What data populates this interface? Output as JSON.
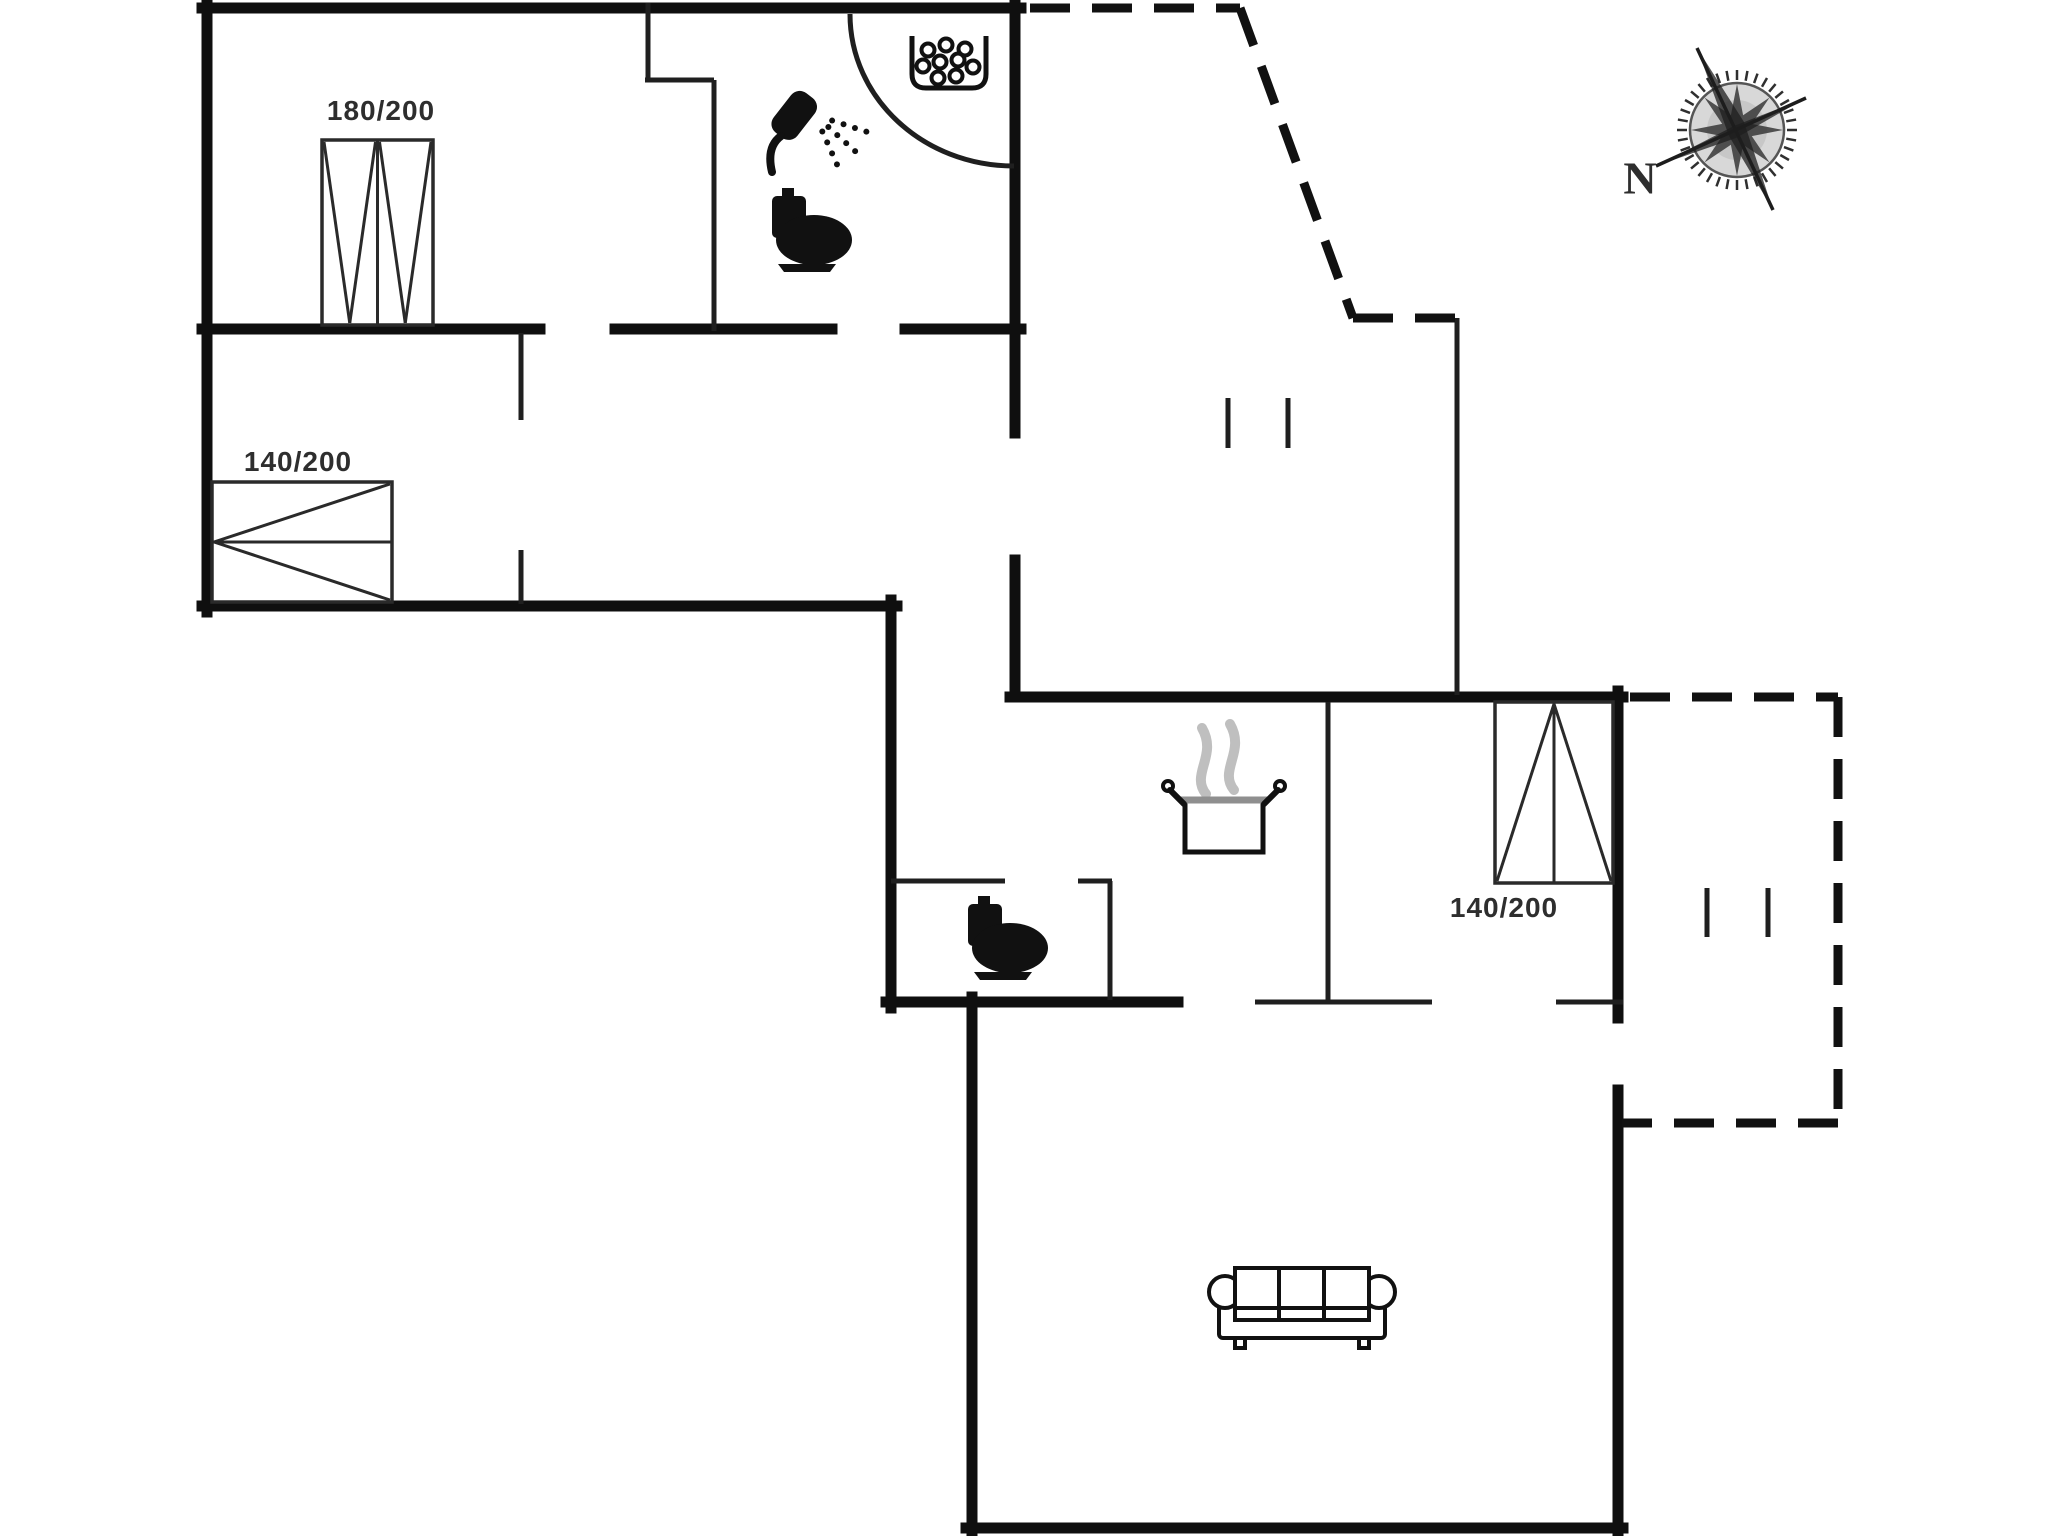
{
  "page": {
    "width": 2048,
    "height": 1536,
    "background": "#ffffff"
  },
  "colors": {
    "wall": "#0f0f0f",
    "thin_line": "#1f1f1f",
    "bed_line": "#2a2a2a",
    "dashed_boundary": "#111111",
    "icon": "#111111",
    "steam": "#bfbfbf",
    "pot_rim": "#8f8f8f",
    "compass_fill": "#d8d8d8",
    "compass_star": "#3c3c3c",
    "label_text": "#2e2e2e"
  },
  "plan": {
    "wall_thickness": 11,
    "thin_thickness": 5,
    "dash_pattern": [
      40,
      22
    ],
    "walls_thick": [
      [
        202,
        8,
        1021,
        8
      ],
      [
        207,
        3,
        207,
        612
      ],
      [
        202,
        606,
        897,
        606
      ],
      [
        891,
        600,
        891,
        1008
      ],
      [
        1015,
        3,
        1015,
        433
      ],
      [
        1015,
        560,
        1015,
        697
      ],
      [
        1010,
        697,
        1623,
        697
      ],
      [
        1618,
        691,
        1618,
        1018
      ],
      [
        1618,
        1090,
        1618,
        1533
      ],
      [
        886,
        1002,
        1178,
        1002
      ],
      [
        972,
        997,
        972,
        1533
      ],
      [
        966,
        1528,
        1623,
        1528
      ],
      [
        202,
        329,
        540,
        329
      ],
      [
        615,
        329,
        832,
        329
      ],
      [
        905,
        329,
        1021,
        329
      ]
    ],
    "walls_thin": [
      [
        648,
        3,
        648,
        78
      ],
      [
        645,
        80,
        714,
        80
      ],
      [
        714,
        80,
        714,
        331
      ],
      [
        521,
        333,
        521,
        420
      ],
      [
        521,
        550,
        521,
        604
      ],
      [
        891,
        881,
        1005,
        881
      ],
      [
        1078,
        881,
        1112,
        881
      ],
      [
        1110,
        881,
        1110,
        1000
      ],
      [
        1328,
        702,
        1328,
        1000
      ],
      [
        1457,
        318,
        1457,
        695
      ],
      [
        1255,
        1002,
        1432,
        1002
      ],
      [
        1556,
        1002,
        1623,
        1002
      ]
    ],
    "dashed": [
      [
        1030,
        8,
        1240,
        8
      ],
      [
        1240,
        8,
        1353,
        318
      ],
      [
        1353,
        318,
        1462,
        318
      ],
      [
        1630,
        697,
        1838,
        697
      ],
      [
        1838,
        697,
        1838,
        1123
      ],
      [
        1838,
        1123,
        1622,
        1123
      ]
    ],
    "door_arc": {
      "from": [
        850,
        14
      ],
      "c1": [
        850,
        98
      ],
      "c2": [
        923,
        166
      ],
      "to": [
        1014,
        166
      ]
    },
    "posts": [
      [
        1228,
        398,
        1228,
        448
      ],
      [
        1288,
        398,
        1288,
        448
      ],
      [
        1707,
        888,
        1707,
        937
      ],
      [
        1768,
        888,
        1768,
        937
      ]
    ],
    "beds": [
      {
        "name": "bed-180x200",
        "rect": [
          322,
          140,
          111,
          185
        ],
        "style": "double-v",
        "apex": "bottom"
      },
      {
        "name": "bed-140x200-left",
        "rect": [
          212,
          482,
          180,
          120
        ],
        "style": "single-v",
        "apex": "left"
      },
      {
        "name": "bed-140x200-right",
        "rect": [
          1495,
          702,
          118,
          181
        ],
        "style": "single-v",
        "apex": "top"
      }
    ],
    "labels": [
      {
        "name": "bed-size-label-1",
        "text": "180/200",
        "x": 381,
        "y": 111,
        "size": 28
      },
      {
        "name": "bed-size-label-2",
        "text": "140/200",
        "x": 298,
        "y": 462,
        "size": 28
      },
      {
        "name": "bed-size-label-3",
        "text": "140/200",
        "x": 1504,
        "y": 908,
        "size": 28
      },
      {
        "name": "compass-north-label",
        "text": "N",
        "x": 1640,
        "y": 178,
        "size": 46,
        "serif": true
      }
    ],
    "icons": [
      {
        "name": "shower-icon",
        "type": "shower",
        "x": 765,
        "y": 95
      },
      {
        "name": "toilet-icon",
        "type": "toilet",
        "x": 770,
        "y": 188
      },
      {
        "name": "toilet-icon",
        "type": "toilet",
        "x": 966,
        "y": 896
      },
      {
        "name": "spa-bubbles-icon",
        "type": "spa",
        "x": 910,
        "y": 36
      },
      {
        "name": "cooking-pot-icon",
        "type": "pot",
        "x": 1168,
        "y": 712
      },
      {
        "name": "sofa-icon",
        "type": "sofa",
        "x": 1213,
        "y": 1262
      },
      {
        "name": "compass-rose-icon",
        "type": "compass",
        "x": 1737,
        "y": 130
      }
    ]
  }
}
